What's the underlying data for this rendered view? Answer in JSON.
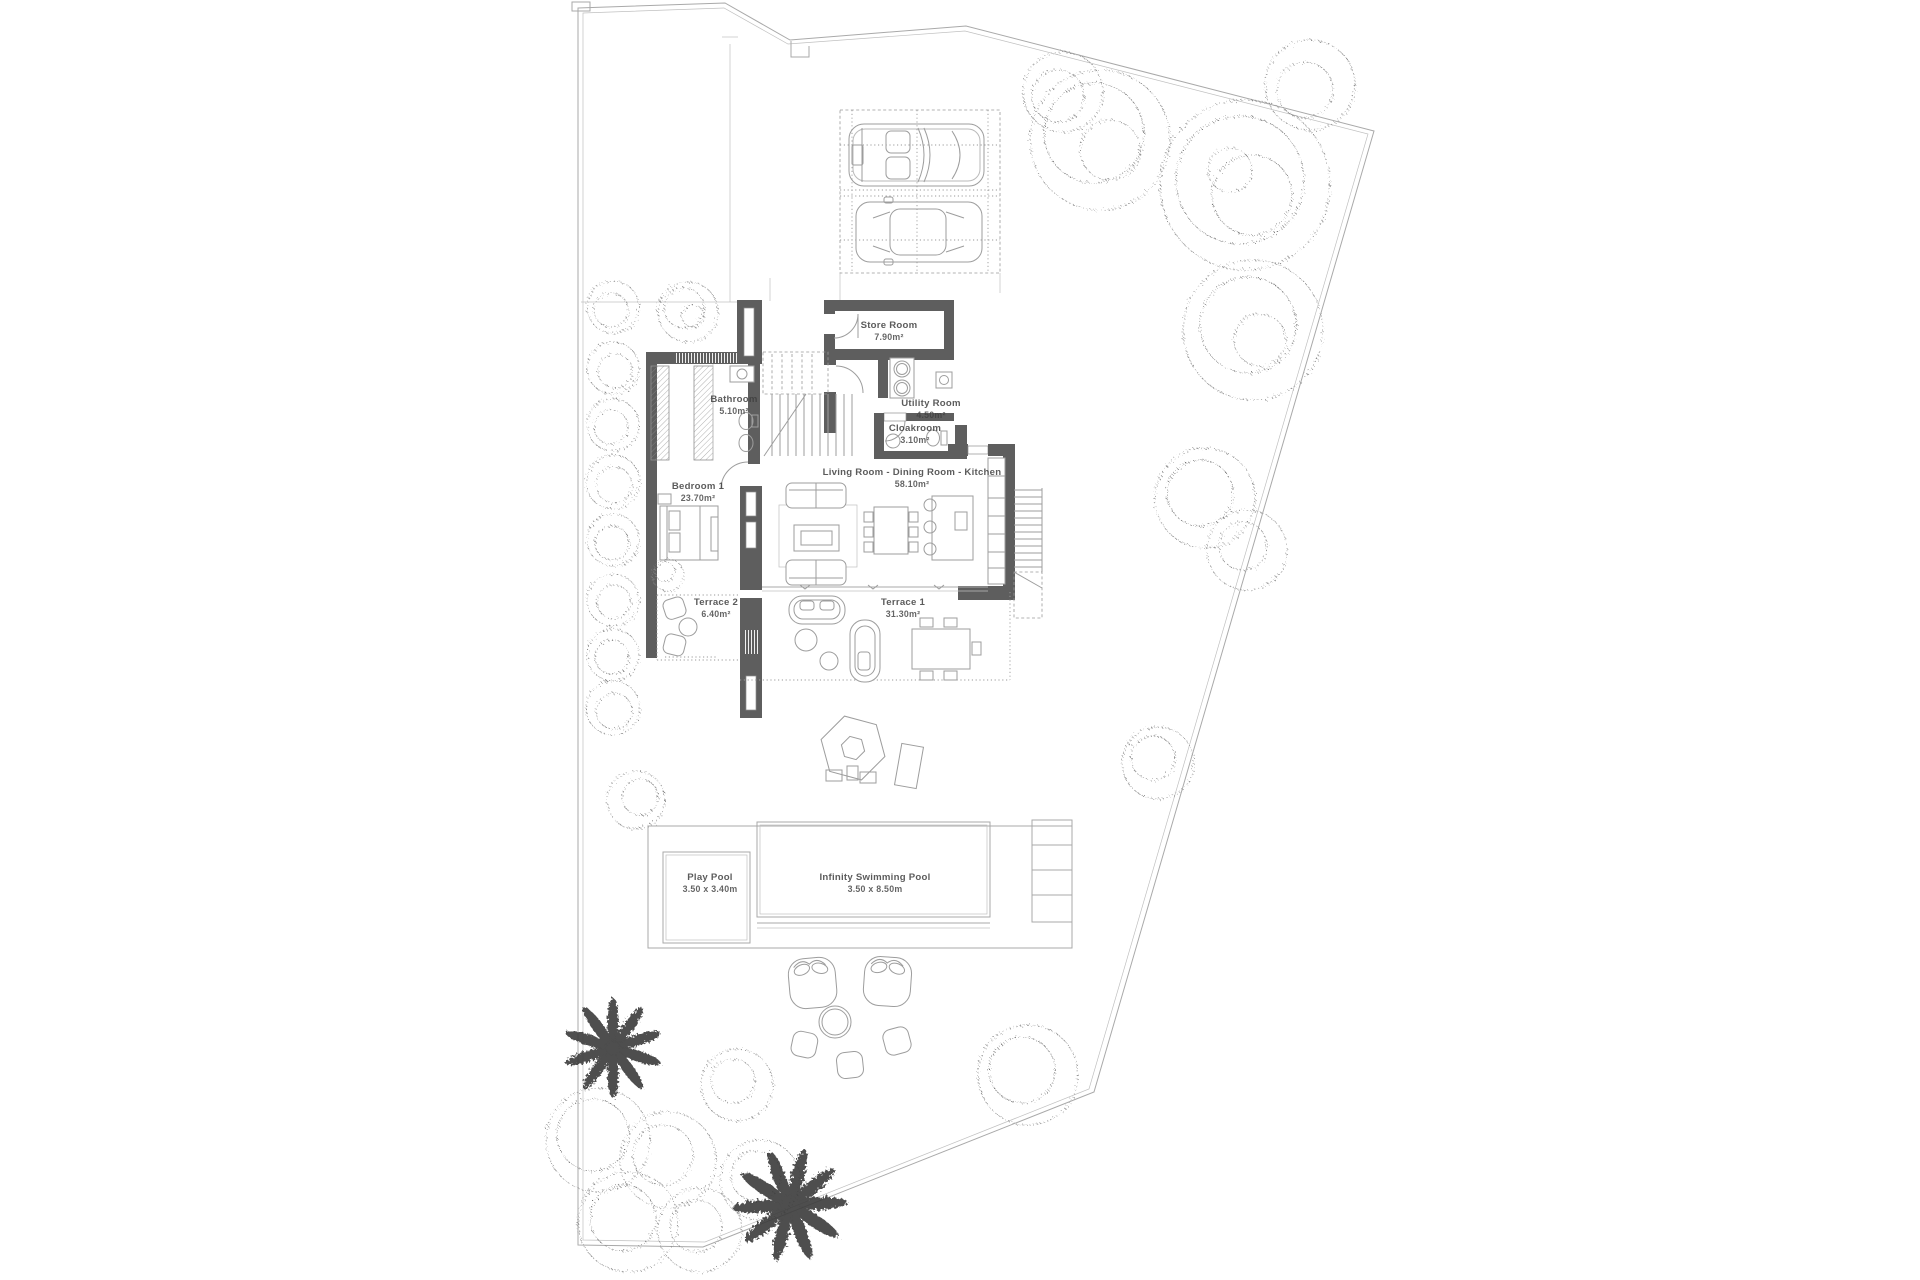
{
  "plan": {
    "rooms": {
      "store": {
        "name": "Store Room",
        "area": "7.90m²"
      },
      "bathroom": {
        "name": "Bathroom",
        "area": "5.10m²"
      },
      "utility": {
        "name": "Utility Room",
        "area": "4.50m²"
      },
      "cloakroom": {
        "name": "Cloakroom",
        "area": "3.10m²"
      },
      "living": {
        "name": "Living Room - Dining Room - Kitchen",
        "area": "58.10m²"
      },
      "bedroom1": {
        "name": "Bedroom 1",
        "area": "23.70m²"
      },
      "terrace2": {
        "name": "Terrace 2",
        "area": "6.40m²"
      },
      "terrace1": {
        "name": "Terrace 1",
        "area": "31.30m²"
      }
    },
    "pools": {
      "play": {
        "name": "Play Pool",
        "dims": "3.50 x 3.40m"
      },
      "infinity": {
        "name": "Infinity Swimming Pool",
        "dims": "3.50 x 8.50m"
      }
    },
    "colors": {
      "wall": "#5e5e5e",
      "line": "#a9a9a9",
      "text": "#3f3f3f",
      "vegetation": "#8c8c8c",
      "palm": "#3a3a3a"
    }
  }
}
